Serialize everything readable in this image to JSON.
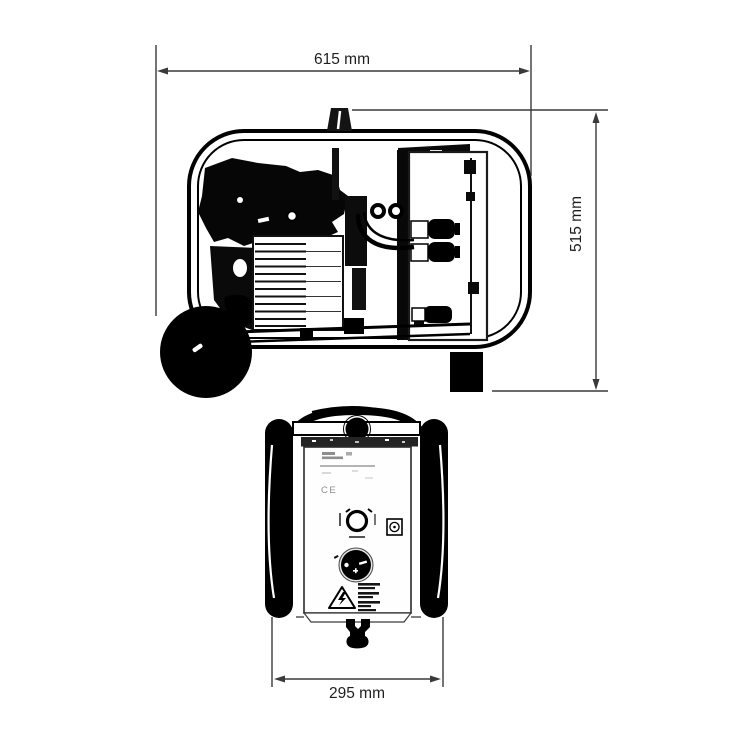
{
  "document": {
    "type": "technical dimension drawing, two orthographic views of a wheeled compressor unit",
    "background": "#ffffff"
  },
  "dimensions": {
    "width": {
      "label": "615 mm",
      "value": 615,
      "unit": "mm"
    },
    "height": {
      "label": "515 mm",
      "value": 515,
      "unit": "mm"
    },
    "depth": {
      "label": "295 mm",
      "value": 295,
      "unit": "mm"
    }
  },
  "front_panel": {
    "ce_mark": "CE"
  },
  "colors": {
    "ink": "#000000",
    "dimension_line": "#3a3a3a",
    "background": "#ffffff"
  }
}
